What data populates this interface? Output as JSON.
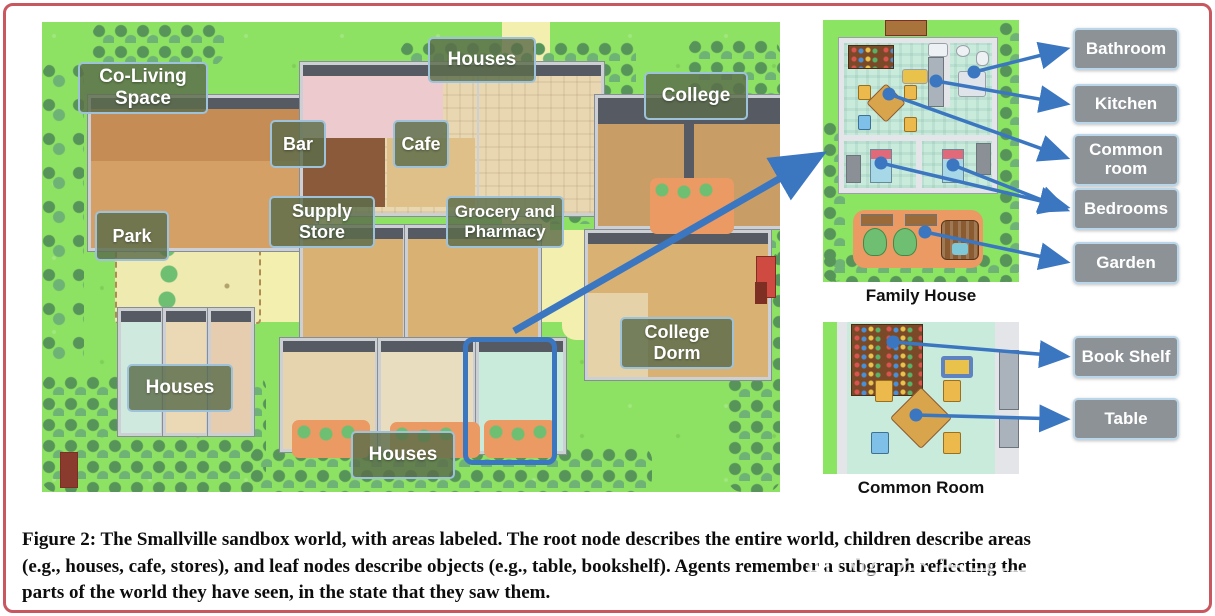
{
  "figure": {
    "caption": {
      "figure_label": "Figure 2:",
      "line1_rest": " The Smallville sandbox world, with areas labeled. The root node describes the entire world, children describe areas",
      "line2": "(e.g., houses, cafe, stores), and leaf nodes describe objects (e.g., table, bookshelf). Agents remember a subgraph reflecting the",
      "line3": "parts of the world they have seen, in the state that they saw them."
    },
    "watermark": "知乎 @百无一用是书生"
  },
  "map": {
    "area_labels": [
      {
        "id": "co-living-space",
        "text": "Co-Living Space"
      },
      {
        "id": "houses-top",
        "text": "Houses"
      },
      {
        "id": "college",
        "text": "College"
      },
      {
        "id": "bar",
        "text": "Bar"
      },
      {
        "id": "cafe",
        "text": "Cafe"
      },
      {
        "id": "park",
        "text": "Park"
      },
      {
        "id": "supply-store",
        "text": "Supply Store"
      },
      {
        "id": "grocery-pharmacy",
        "text": "Grocery and Pharmacy"
      },
      {
        "id": "college-dorm",
        "text": "College Dorm"
      },
      {
        "id": "houses-bottom-left",
        "text": "Houses"
      },
      {
        "id": "houses-bottom-middle",
        "text": "Houses"
      }
    ]
  },
  "panels": {
    "family_house": {
      "caption": "Family House",
      "labels": [
        {
          "id": "bathroom",
          "text": "Bathroom"
        },
        {
          "id": "kitchen",
          "text": "Kitchen"
        },
        {
          "id": "common-room",
          "text": "Common room"
        },
        {
          "id": "bedrooms",
          "text": "Bedrooms"
        },
        {
          "id": "garden",
          "text": "Garden"
        }
      ]
    },
    "common_room": {
      "caption": "Common Room",
      "labels": [
        {
          "id": "book-shelf",
          "text": "Book Shelf"
        },
        {
          "id": "table",
          "text": "Table"
        }
      ]
    }
  },
  "colors": {
    "arrow": "#3b76c1",
    "highlight_box": "#3b76c1",
    "page_border": "#c8575f",
    "map_label_bg": "rgba(92,108,74,0.82)",
    "map_label_border": "#9dc2da",
    "room_label_bg": "#8d9297",
    "room_label_border": "#b9d6ea",
    "grass": "#8de163",
    "path": "#f3efae"
  }
}
